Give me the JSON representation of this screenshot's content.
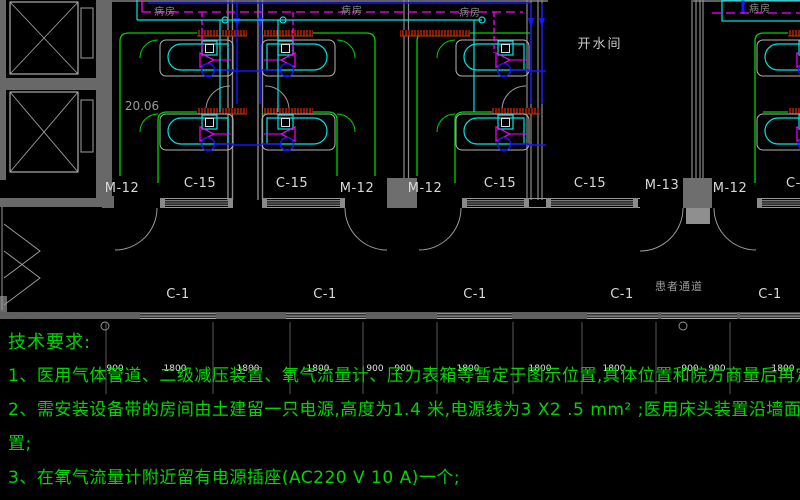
{
  "notes": {
    "title": "技术要求:",
    "line1": "1、医用气体管道、二级减压装置、氧气流量计、压力表箱等暂定于图示位置,具体位置和院方商量后再定",
    "line2": "2、需安装设备带的房间由土建留一只电源,高度为1.4 米,电源线为3 X2 .5 mm² ;医用床头装置沿墙面装",
    "line2_cont": "置;",
    "line3": "3、在氧气流量计附近留有电源插座(AC220 V 10 A)一个;"
  },
  "plan": {
    "ward_labels": [
      "病房",
      "病房",
      "病房",
      "病房"
    ],
    "hot_water_room": "开水间",
    "patient_corridor": "患者通道",
    "level_mark": "20.06",
    "door_labels": [
      "M-12",
      "M-12",
      "M-12",
      "M-13",
      "M-12"
    ],
    "front_window_labels": [
      "C-15",
      "C-15",
      "C-15",
      "C-15",
      "C-15"
    ],
    "corridor_window_labels": [
      "C-1",
      "C-1",
      "C-1",
      "C-1",
      "C-1"
    ],
    "dimensions": [
      "900",
      "1800",
      "1800",
      "1800",
      "900",
      "900",
      "1800",
      "1800",
      "1800",
      "900",
      "900",
      "1800"
    ]
  },
  "colors": {
    "notes_green": "#00d600",
    "outline_green": "#00d400",
    "pipe_blue": "#1515ff",
    "pipe_cyan": "#00e5e5",
    "pipe_magenta": "#ff00ff",
    "hatch_red": "#ff2a00",
    "wall_gray": "#6e6e6e",
    "label_white": "#d8d8d8"
  }
}
